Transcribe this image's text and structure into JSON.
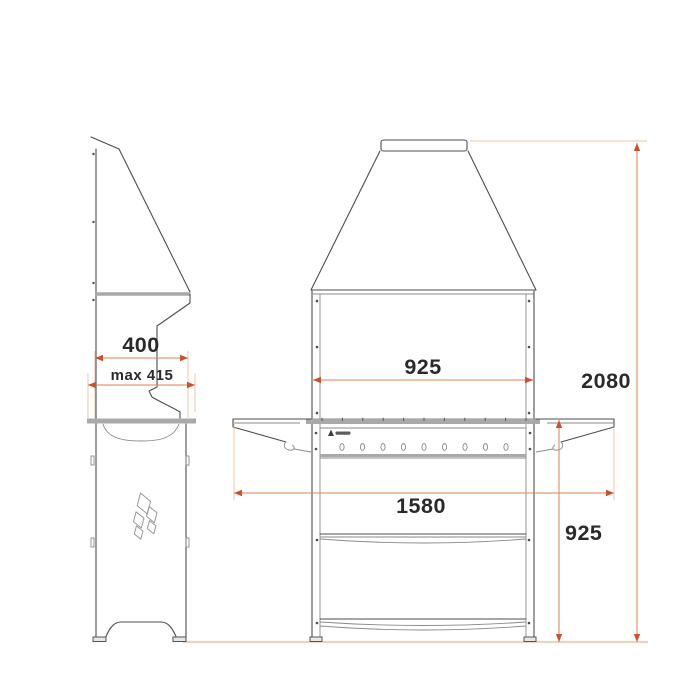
{
  "drawing": {
    "kind": "technical-dimension-drawing",
    "views": {
      "left": "side-elevation",
      "right": "front-elevation"
    }
  },
  "dimensions": {
    "side_width": {
      "label": "400"
    },
    "side_width_max": {
      "label": "max 415"
    },
    "grill_width": {
      "label": "925"
    },
    "overall_width": {
      "label": "1580"
    },
    "grill_height": {
      "label": "925"
    },
    "overall_height": {
      "label": "2080"
    }
  },
  "icons": {
    "side_panel_logo": "diamond-flame-logo",
    "rack_logo": "brand-logo"
  },
  "colors": {
    "background": "#ffffff",
    "outline": "#4d4d4d",
    "light_gray": "#a9a9a9",
    "dimension_line": "#de8252",
    "dimension_extension": "#f0c5a9",
    "dimension_arrow": "#c8512e",
    "dimension_text": "#2a2a2a",
    "ground_line": "#e9d5c0"
  }
}
